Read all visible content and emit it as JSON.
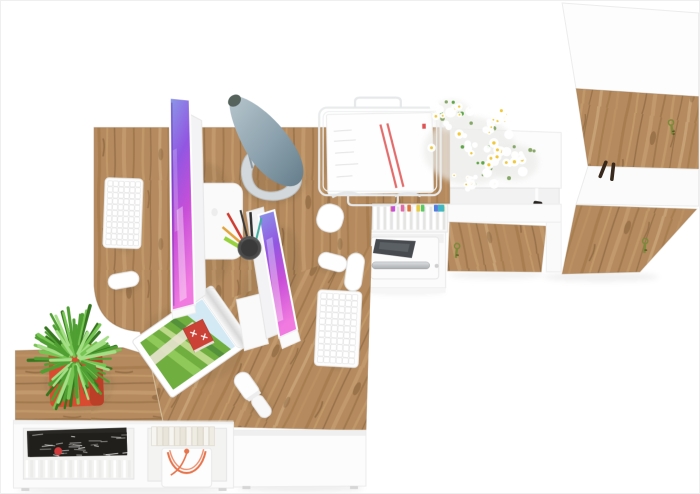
{
  "meta": {
    "type": "3d-render",
    "subject": "Top view of a two-person office workspace with oak desks, iMac-style monitors, lamp, printer and white-oak cabinets",
    "width": 700,
    "height": 494
  },
  "palette": {
    "background": "#ffffff",
    "wood": "#b48a5e",
    "wood_light": "#d2b084",
    "wood_dark": "#8a6743",
    "wood_edge": "#8f6c45",
    "white_furniture": "#fbfbfb",
    "furniture_line": "#ececec",
    "inset_shadow": "#f2f2f2",
    "screen_blue": "#8a9ae8",
    "screen_purple": "#9257e2",
    "screen_magenta": "#c94fd8",
    "screen_pink": "#f07ae0",
    "lamp_steel_light": "#b7c6cd",
    "lamp_steel_dark": "#657d8b",
    "lamp_base": "#d2d8db",
    "pot": "#d84b31",
    "pot_dark": "#b13a24",
    "plant_greens": [
      "#35761f",
      "#4f9f33",
      "#76c452",
      "#a4de85"
    ],
    "daisy_petal": "#ffffff",
    "daisy_center": "#f0c838",
    "daisy_leaf": "#7b9e58",
    "chrome": "#c2c6c9",
    "printer_slot": "#474b4f",
    "magazine_sky": "#d3eaf5",
    "magazine_field": [
      "#55913a",
      "#6fae3f",
      "#8ec95a",
      "#bcd98a"
    ],
    "magazine_path": "#e9e4d2",
    "magazine_house": "#cb4136",
    "dark_print": "#2a2824",
    "badge_red": "#d23b3b",
    "cord_orange": "#e8734a",
    "stripe_red": "#e05252",
    "key_olive": "#7c8a3c",
    "key_olive_dark": "#4a521f",
    "handle_brown": "#38291c",
    "pen_colors": [
      "#cf3b2f",
      "#3a3a3a",
      "#2f2f2f",
      "#e2a33c",
      "#97d23e",
      "#3fae9e"
    ],
    "tab_colors": [
      "#e06aa8",
      "#c44fd8",
      "#5ac95f",
      "#3fb7c9",
      "#e8c93f",
      "#4f7fe0",
      "#e0743f"
    ]
  },
  "counts": {
    "daisies": 72,
    "daisy_leaves": 26,
    "plant_leaves_dark": 45,
    "plant_leaves_light": 72,
    "files": 24,
    "file_tabs": 12,
    "book_spines": 11,
    "page_stack_lines": 22,
    "magazine_scribbles": 28,
    "keyboard_rows": 11,
    "keyboard_cols": 6
  },
  "objects": [
    "angled oak two-person desk",
    "oak bench shelf with succulent in red pot",
    "white sideboard with magazines, books and gift bag with orange cord",
    "iMac-style monitor (x2) with purple abstract wallpaper",
    "white keyboard (x2)",
    "white mouse (x2)",
    "steel-blue desk lamp",
    "wire pen cup with pens",
    "white wire paper tray with documents",
    "under-desk shelf with colorful file folders",
    "white printer in open cabinet",
    "white sideboard with oak door and key",
    "daisy bouquet on cabinet top",
    "tall white cabinet with oak doors, key and dark handle",
    "cable grommets",
    "rolled magazine with red-house landscape",
    "white remote control"
  ]
}
